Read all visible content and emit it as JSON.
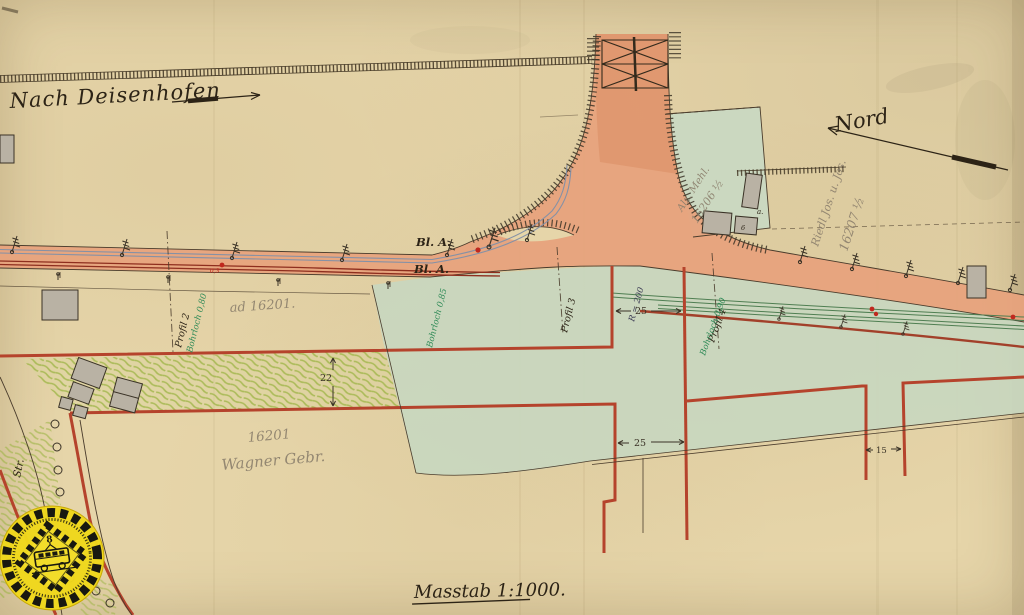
{
  "map": {
    "scale_caption": "Masstab 1:1000.",
    "direction_left": "Nach Deisenhofen",
    "direction_north": "Nord",
    "signals": {
      "bl_a_upper": "Bl. A.",
      "bl_a_lower": "Bl. A."
    },
    "profiles": [
      {
        "label": "Profil 2",
        "borehole": "Bohrloch 0,80"
      },
      {
        "label": "Profil 3",
        "borehole": "Bohrloch 0,85"
      },
      {
        "label": "Profil 4",
        "borehole": "Bohrloch 0,90"
      }
    ],
    "curve_radius": "R = 200",
    "dimensions": {
      "strip_width": "22",
      "gap_left": "25",
      "gap_mid": "25",
      "gap_right": "15"
    },
    "parcels": [
      {
        "number": "ad 16201."
      },
      {
        "number": "16201",
        "owner": "Wagner Gebr."
      },
      {
        "number": "16206 ½",
        "owner": "Alz. Mehl."
      },
      {
        "number": "16207 ½",
        "owner": "Riedl Jos. u. Jos."
      }
    ],
    "street_label": "Str.",
    "building_label": "6",
    "annotation_a": "a.",
    "track_mark": "0,3",
    "stamp": {
      "center_glyph": "8"
    },
    "colors": {
      "paper": "#e6d5a9",
      "road_orange": "#e7a27c",
      "parcel_red": "#b5432c",
      "track_dark_red": "#8e2e1e",
      "track_blue": "#8591a6",
      "track_green": "#4f7e52",
      "wash_green": "#c8d7c0",
      "crayon_green": "#9fb549",
      "stamp_yellow": "#f0d81c"
    }
  }
}
